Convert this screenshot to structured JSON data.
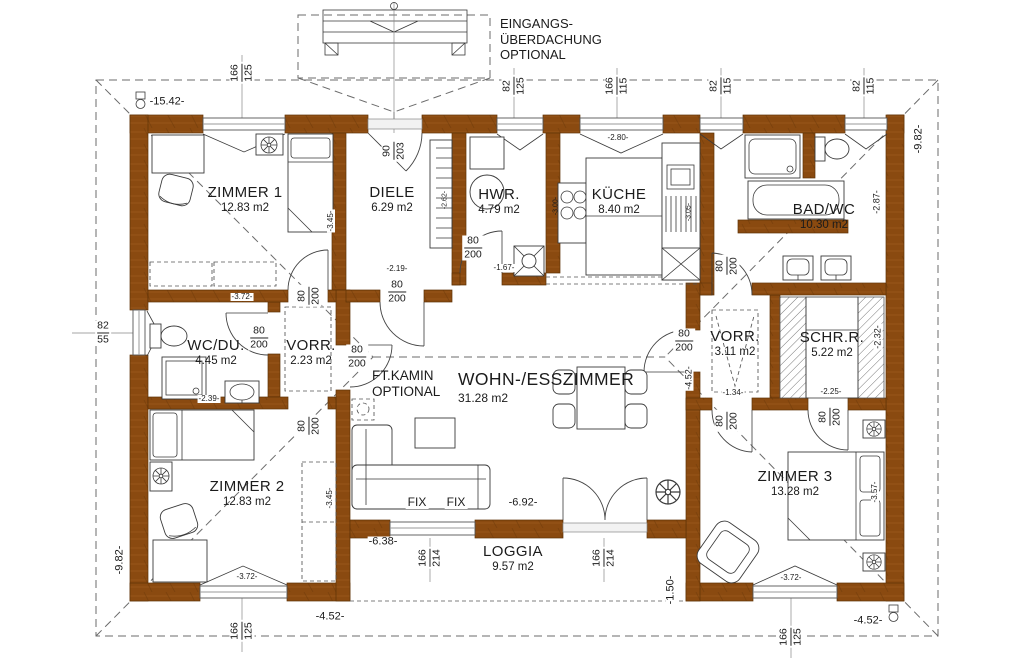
{
  "colors": {
    "wall": "#8a4a10",
    "wall_edge": "#5f3206",
    "line": "#2e2e2e"
  },
  "rooms": [
    {
      "name": "ZIMMER 1",
      "area": "12.83 m2"
    },
    {
      "name": "DIELE",
      "area": "6.29 m2"
    },
    {
      "name": "HWR.",
      "area": "4.79 m2"
    },
    {
      "name": "KÜCHE",
      "area": "8.40 m2"
    },
    {
      "name": "BAD/WC",
      "area": "10.30 m2"
    },
    {
      "name": "WC/DU.",
      "area": "4.45 m2"
    },
    {
      "name": "VORR.",
      "area": "2.23 m2"
    },
    {
      "name": "WOHN-/ESSZIMMER",
      "area": "31.28 m2"
    },
    {
      "name": "VORR.",
      "area": "3.11 m2"
    },
    {
      "name": "SCHR.R.",
      "area": "5.22 m2"
    },
    {
      "name": "ZIMMER 2",
      "area": "12.83 m2"
    },
    {
      "name": "ZIMMER 3",
      "area": "13.28 m2"
    },
    {
      "name": "LOGGIA",
      "area": "9.57 m2"
    }
  ],
  "fractions": [
    {
      "t": "166",
      "b": "125"
    },
    {
      "t": "90",
      "b": "203"
    },
    {
      "t": "82",
      "b": "125"
    },
    {
      "t": "166",
      "b": "115"
    },
    {
      "t": "82",
      "b": "115"
    },
    {
      "t": "82",
      "b": "115"
    },
    {
      "t": "82",
      "b": "55"
    },
    {
      "t": "80",
      "b": "200"
    },
    {
      "t": "80",
      "b": "200"
    },
    {
      "t": "80",
      "b": "200"
    },
    {
      "t": "80",
      "b": "200"
    },
    {
      "t": "80",
      "b": "200"
    },
    {
      "t": "80",
      "b": "200"
    },
    {
      "t": "80",
      "b": "200"
    },
    {
      "t": "80",
      "b": "200"
    },
    {
      "t": "80",
      "b": "200"
    },
    {
      "t": "80",
      "b": "200"
    },
    {
      "t": "166",
      "b": "214"
    },
    {
      "t": "166",
      "b": "214"
    },
    {
      "t": "166",
      "b": "125"
    },
    {
      "t": "166",
      "b": "125"
    }
  ],
  "dims": [
    "-15.42-",
    "-9.82-",
    "-2.87-",
    "-2.80-",
    "-2.19-",
    "-1.67-",
    "-3.45-",
    "-3.72-",
    "-2.39-",
    "-1.34-",
    "-2.25-",
    "-2.32-",
    "-4.52-",
    "-3.45-",
    "-3.57-",
    "-9.82-",
    "-3.72-",
    "-4.52-",
    "-6.38-",
    "-6.92-",
    "-1.50-",
    "-3.72-",
    "-4.52-",
    "-3.00-",
    "-3.05-",
    "-2.62-"
  ],
  "annotations": {
    "canopy": [
      "EINGANGS-",
      "ÜBERDACHUNG",
      "OPTIONAL"
    ],
    "kamin": [
      "FT.KAMIN",
      "OPTIONAL"
    ],
    "fix_left": "FIX",
    "fix_right": "FIX"
  }
}
